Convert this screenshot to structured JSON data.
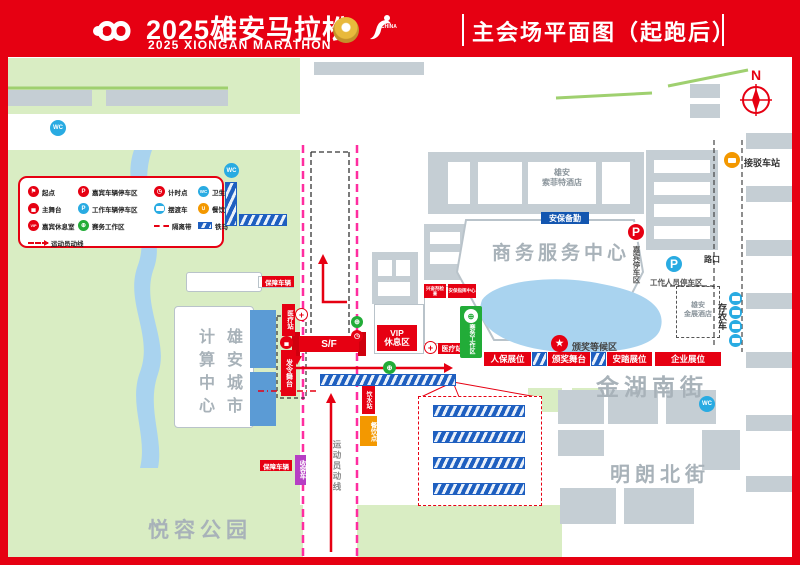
{
  "header": {
    "title_cn": "2025雄安马拉松",
    "title_en": "2025 XIONGAN MARATHON",
    "page_title": "主会场平面图（起跑后）",
    "badge_text": "CHINA"
  },
  "legend": {
    "items": [
      {
        "icon": "start-point-icon",
        "label": "起点"
      },
      {
        "icon": "guest-parking-icon",
        "label": "嘉宾车辆停车区"
      },
      {
        "icon": "timing-point-icon",
        "label": "计时点"
      },
      {
        "icon": "toilet-icon",
        "label": "卫生间"
      },
      {
        "icon": "main-stage-icon",
        "label": "主舞台"
      },
      {
        "icon": "staff-parking-icon",
        "label": "工作车辆停车区"
      },
      {
        "icon": "shuttle-bus-icon",
        "label": "摆渡车"
      },
      {
        "icon": "food-point-icon",
        "label": "餐饮点"
      },
      {
        "icon": "vip-lounge-icon",
        "label": "嘉宾休息室"
      },
      {
        "icon": "race-office-icon",
        "label": "赛务工作区"
      },
      {
        "icon": "divider-line-icon",
        "label": "隔离带"
      },
      {
        "icon": "barricade-icon",
        "label": "铁马"
      },
      {
        "icon": "athlete-route-icon",
        "label": "运动员动线"
      }
    ]
  },
  "map": {
    "compass": "N",
    "streets": {
      "jinhu_south": "金湖南街",
      "minglang_north": "明朗北街"
    },
    "park": "悦容公园",
    "buildings": {
      "sofitel_line1": "雄安",
      "sofitel_line2": "索菲特酒店",
      "business_center": "商务服务中心",
      "computing_col_right": "雄安城市",
      "computing_col_left": "计算中心",
      "jinzhan_line1": "雄安",
      "jinzhan_line2": "金展酒店"
    },
    "facilities": {
      "security_standby": "安保备勤",
      "vip_rest_line1": "VIP",
      "vip_rest_line2": "休息区",
      "sf_arch": "S/F",
      "start_stage": "发令舞台",
      "medical_station": "医疗站",
      "race_office_area": "赛务工作区",
      "award_waiting": "颁奖等候区",
      "doping_check": "兴奋剂检查",
      "security_command": "安保指挥中心",
      "water_station": "饮水站",
      "food_area": "餐饮点",
      "guest_parking": "嘉宾停车区",
      "staff_parking": "工作人员停车区",
      "cloak_bus": "存衣车",
      "shuttle_station": "接驳车站",
      "crossing": "路口",
      "support_vehicle": "保障车辆",
      "sweep_bus": "收容车",
      "athlete_route": "运动员动线",
      "wc": "WC",
      "p": "P"
    },
    "booths": [
      {
        "label": "人保展位"
      },
      {
        "label": "颁奖舞台"
      },
      {
        "label": "安踏展位"
      },
      {
        "label": "企业展位"
      }
    ]
  }
}
